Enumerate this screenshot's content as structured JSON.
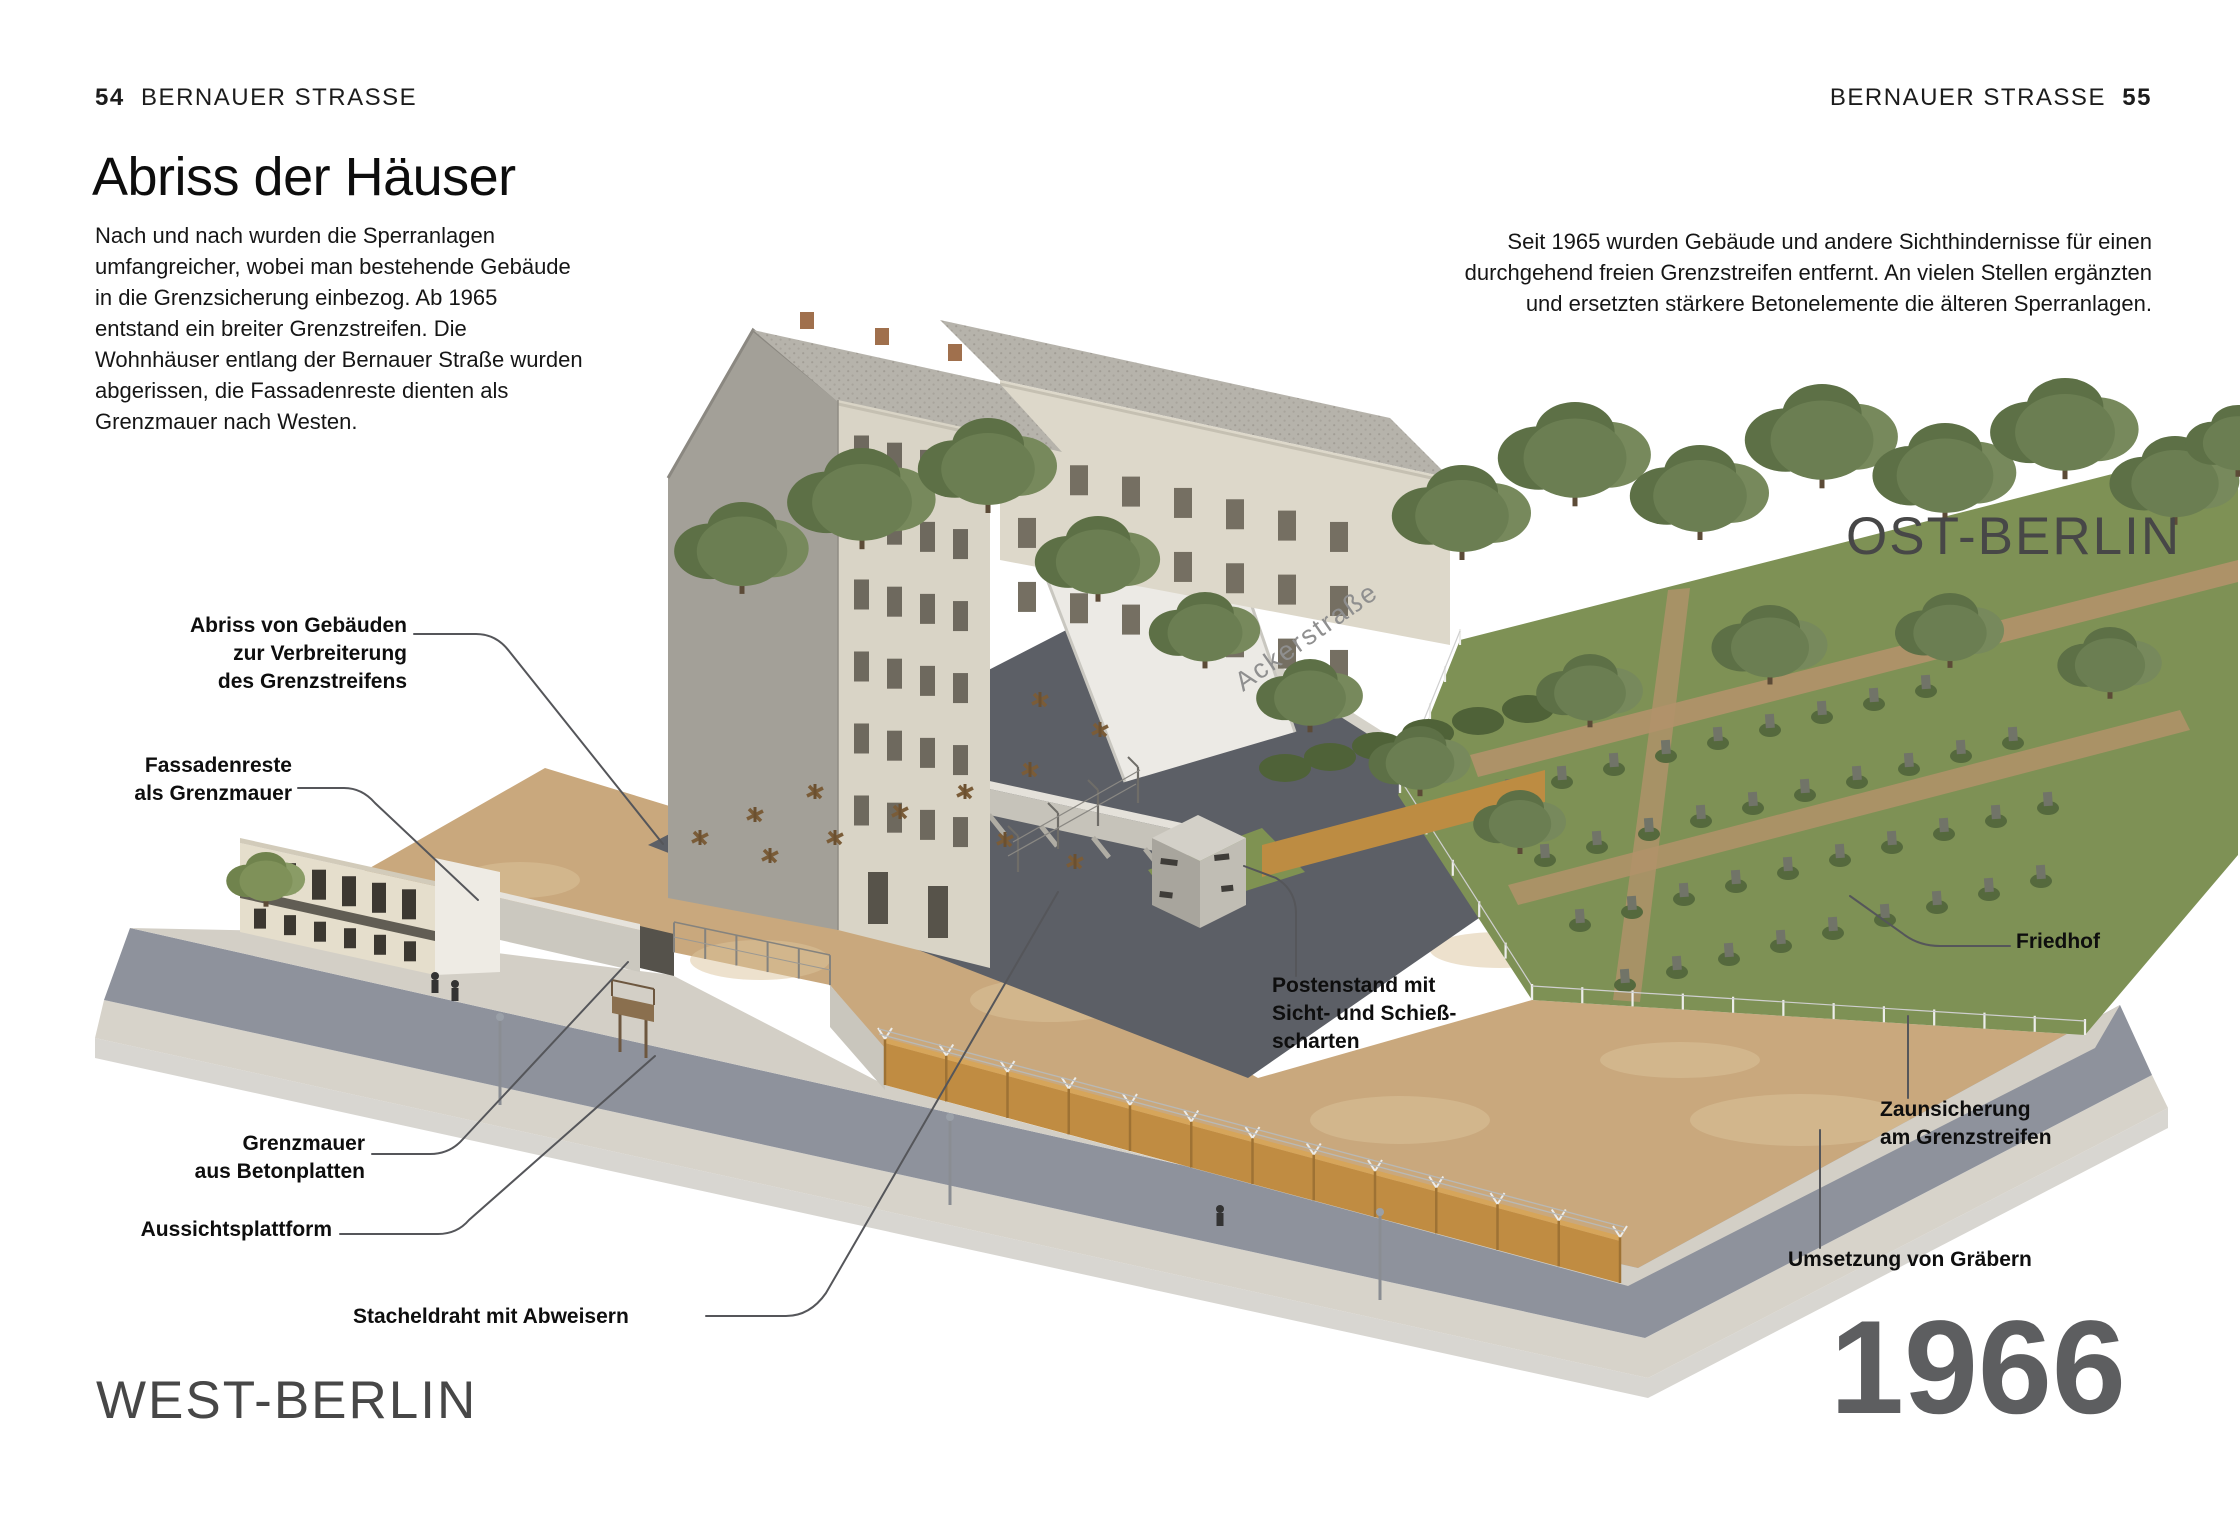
{
  "page": {
    "header_left": {
      "page_num": "54",
      "title": "BERNAUER STRASSE"
    },
    "header_right": {
      "title": "BERNAUER STRASSE",
      "page_num": "55"
    },
    "heading": "Abriss der Häuser",
    "intro_left": "Nach und nach wurden die Sperranlagen umfangreicher, wobei man bestehende Gebäude in die Grenzsicherung einbezog. Ab 1965 entstand ein breiter Grenzstreifen. Die Wohnhäuser entlang der Bernauer Straße wurden abgerissen, die Fassadenreste dienten als Grenzmauer nach Westen.",
    "intro_right": "Seit 1965 wurden Gebäude und andere Sichthindernisse für einen durchgehend freien Grenzstreifen entfernt. An vielen Stellen ergänzten und ersetzten stärkere Betonelemente die älteren Sperranlagen.",
    "region_west": "WEST-BERLIN",
    "region_east": "OST-BERLIN",
    "year": "1966"
  },
  "illustration": {
    "street_name": "Ackerstraße",
    "callouts": {
      "abriss": "Abriss von Gebäuden\nzur Verbreiterung\ndes Grenzstreifens",
      "fassadenreste": "Fassadenreste\nals Grenzmauer",
      "grenzmauer": "Grenzmauer\naus Betonplatten",
      "aussichtsplattform": "Aussichtsplattform",
      "stacheldraht": "Stacheldraht mit Abweisern",
      "postenstand": "Postenstand mit\nSicht- und Schieß-\nscharten",
      "friedhof": "Friedhof",
      "zaunsicherung": "Zaunsicherung\nam Grenzstreifen",
      "umsetzung": "Umsetzung von Gräbern"
    },
    "colors": {
      "dirt": "#c9a87d",
      "asphalt": "#8e929c",
      "dark_asphalt": "#5c5f66",
      "wall_ochre": "#c08c42",
      "grass": "#7e9155",
      "year_gray": "#5d5e60"
    }
  }
}
